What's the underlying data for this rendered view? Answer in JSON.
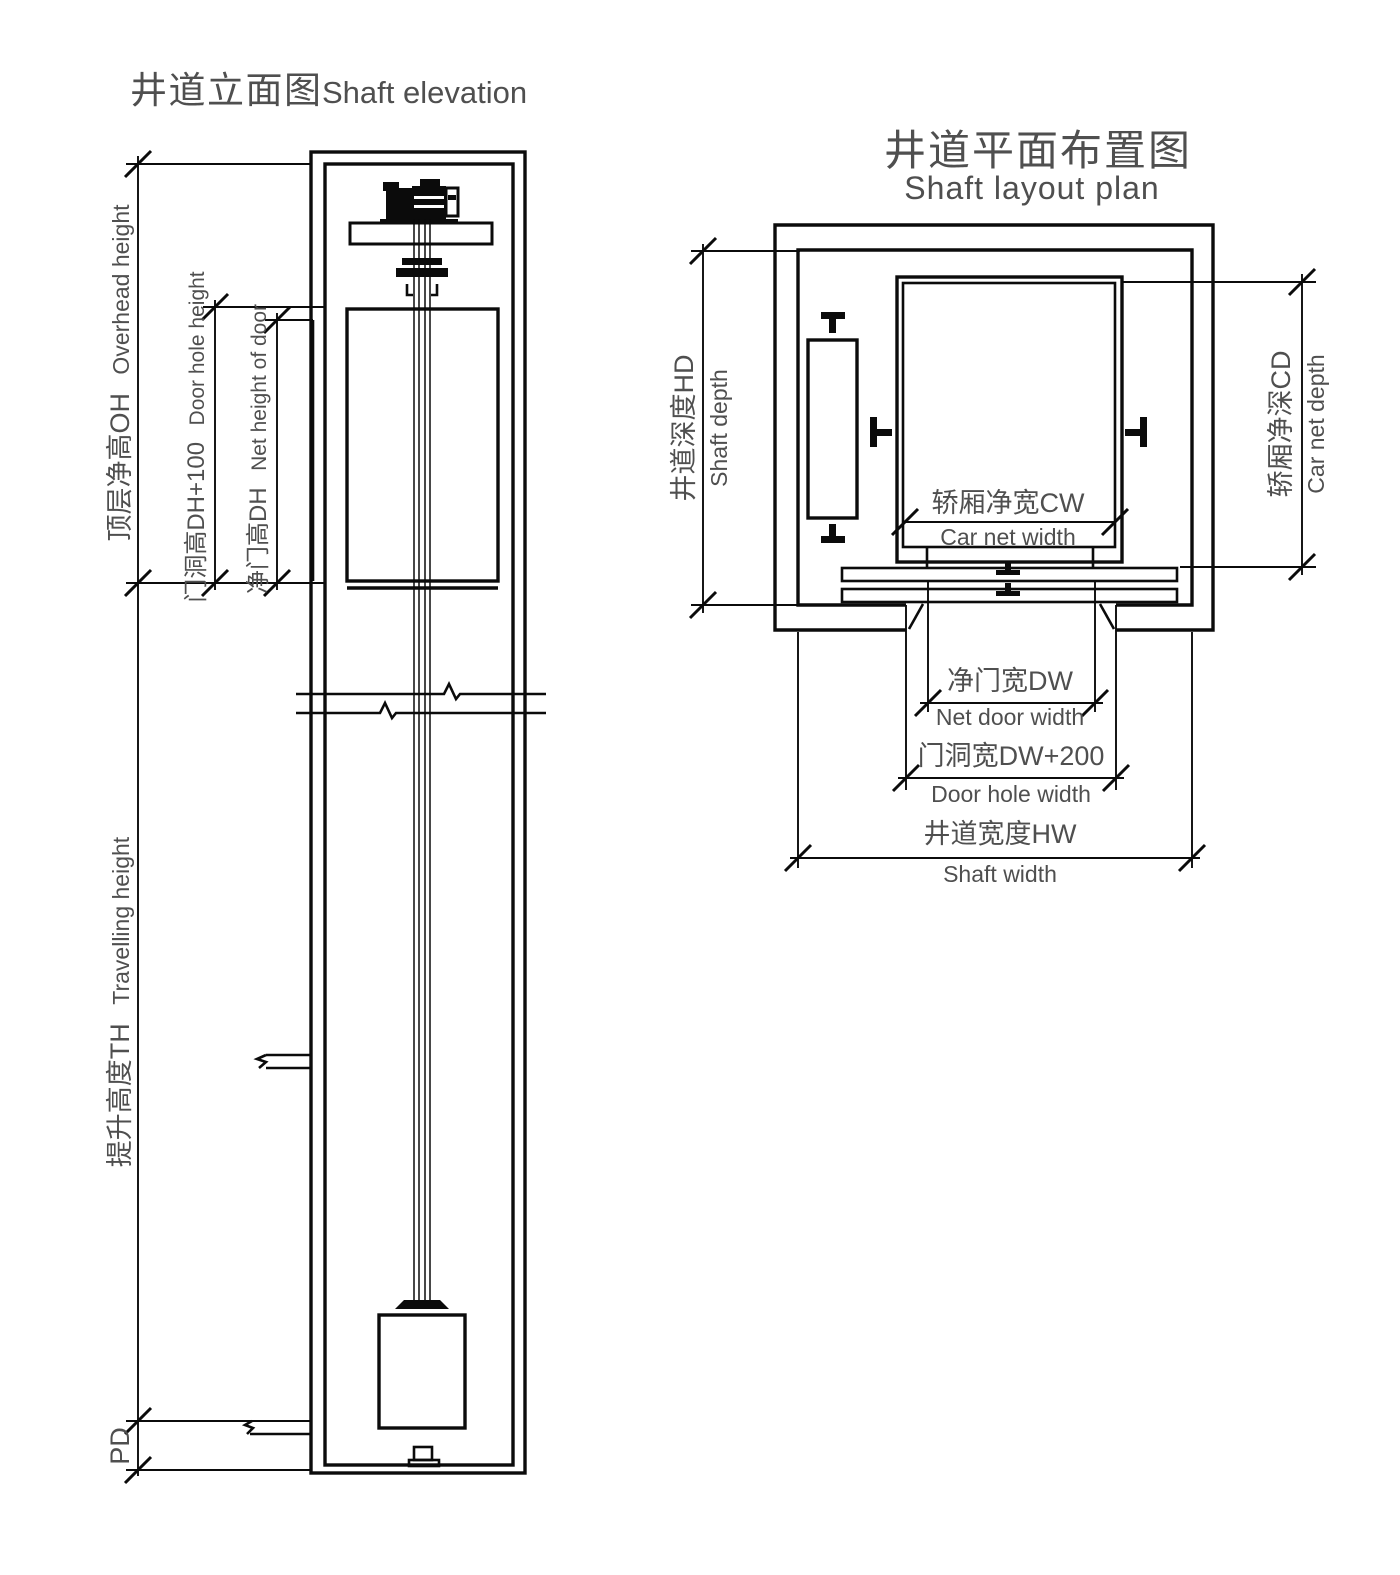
{
  "elevation": {
    "title_zh": "井道立面图",
    "title_en": "Shaft elevation",
    "overhead_zh": "顶层净高OH",
    "overhead_en": "Overhead height",
    "door_hole_zh": "门洞高DH+100",
    "door_hole_en": "Door hole height",
    "net_door_zh": "净门高DH",
    "net_door_en": "Net height of door",
    "travel_zh": "提升高度TH",
    "travel_en": "Travelling height",
    "pit_label": "PD"
  },
  "plan": {
    "title_zh": "井道平面布置图",
    "title_en": "Shaft layout plan",
    "shaft_depth_zh": "井道深度HD",
    "shaft_depth_en": "Shaft depth",
    "car_depth_zh": "轿厢净深CD",
    "car_depth_en": "Car net depth",
    "car_width_zh": "轿厢净宽CW",
    "car_width_en": "Car net width",
    "net_door_zh": "净门宽DW",
    "net_door_en": "Net door width",
    "door_hole_zh": "门洞宽DW+200",
    "door_hole_en": "Door hole width",
    "shaft_width_zh": "井道宽度HW",
    "shaft_width_en": "Shaft width"
  },
  "colors": {
    "line": "#0b0b0b",
    "text": "#4f4f4f",
    "background": "#ffffff"
  }
}
